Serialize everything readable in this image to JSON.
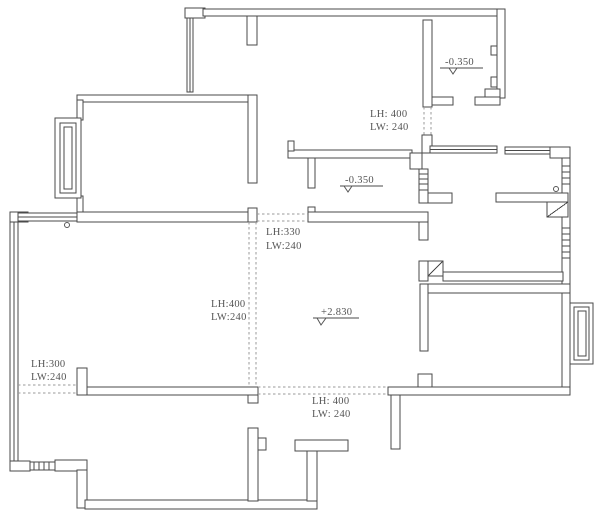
{
  "plan": {
    "elevations": {
      "upper_right_room": "-0.350",
      "hallway": "-0.350",
      "living_room": "+2.830"
    },
    "openings": {
      "upper_right_door": {
        "lh": "LH: 400",
        "lw": "LW: 240"
      },
      "hall_passage": {
        "lh": "LH:330",
        "lw": "LW:240"
      },
      "left_mid_passage": {
        "lh": "LH:400",
        "lw": "LW:240"
      },
      "left_lower_door": {
        "lh": "LH:300",
        "lw": "LW:240"
      },
      "bottom_passage": {
        "lh": "LH: 400",
        "lw": "LW: 240"
      }
    },
    "colors": {
      "wall_line": "#4a4a4a",
      "dash_line": "#9a9a9a",
      "background": "#ffffff",
      "text": "#555555"
    }
  }
}
